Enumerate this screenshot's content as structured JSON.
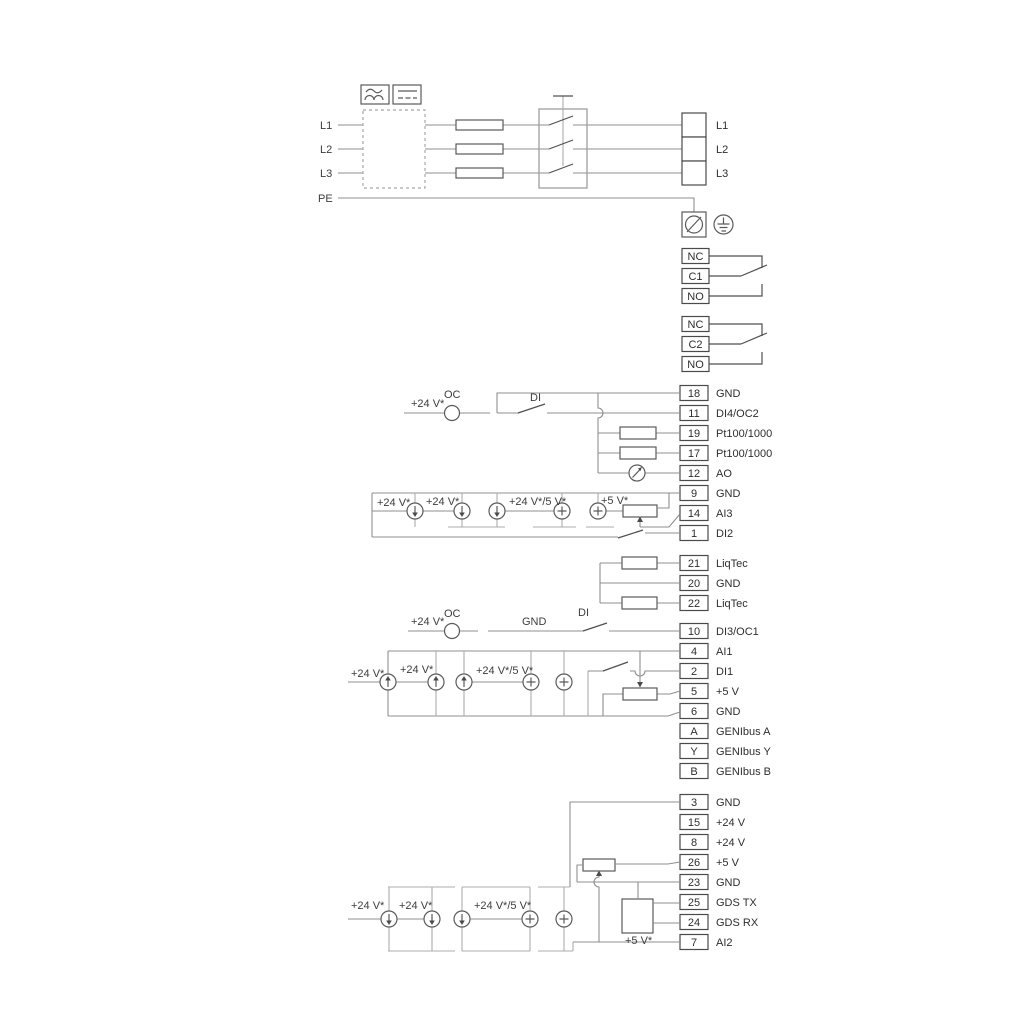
{
  "labels": {
    "v24": "+24 V*",
    "v24_5": "+24 V*/5 V*",
    "v5": "+5 V*",
    "oc": "OC",
    "di": "DI",
    "gnd": "GND"
  },
  "power": {
    "inputs": [
      "L1",
      "L2",
      "L3",
      "PE"
    ],
    "outputs": [
      "L1",
      "L2",
      "L3"
    ]
  },
  "relays": [
    {
      "cells": [
        "NC",
        "C1",
        "NO"
      ]
    },
    {
      "cells": [
        "NC",
        "C2",
        "NO"
      ]
    }
  ],
  "terminals": [
    {
      "num": "18",
      "label": "GND"
    },
    {
      "num": "11",
      "label": "DI4/OC2"
    },
    {
      "num": "19",
      "label": "Pt100/1000"
    },
    {
      "num": "17",
      "label": "Pt100/1000"
    },
    {
      "num": "12",
      "label": "AO"
    },
    {
      "num": "9",
      "label": "GND"
    },
    {
      "num": "14",
      "label": "AI3"
    },
    {
      "num": "1",
      "label": "DI2"
    },
    {
      "num": "21",
      "label": "LiqTec"
    },
    {
      "num": "20",
      "label": "GND"
    },
    {
      "num": "22",
      "label": "LiqTec"
    },
    {
      "num": "10",
      "label": "DI3/OC1"
    },
    {
      "num": "4",
      "label": "AI1"
    },
    {
      "num": "2",
      "label": "DI1"
    },
    {
      "num": "5",
      "label": "+5 V"
    },
    {
      "num": "6",
      "label": "GND"
    },
    {
      "num": "A",
      "label": "GENIbus A"
    },
    {
      "num": "Y",
      "label": "GENIbus Y"
    },
    {
      "num": "B",
      "label": "GENIbus B"
    },
    {
      "num": "3",
      "label": "GND"
    },
    {
      "num": "15",
      "label": "+24 V"
    },
    {
      "num": "8",
      "label": "+24 V"
    },
    {
      "num": "26",
      "label": "+5 V"
    },
    {
      "num": "23",
      "label": "GND"
    },
    {
      "num": "25",
      "label": "GDS TX"
    },
    {
      "num": "24",
      "label": "GDS RX"
    },
    {
      "num": "7",
      "label": "AI2"
    }
  ]
}
